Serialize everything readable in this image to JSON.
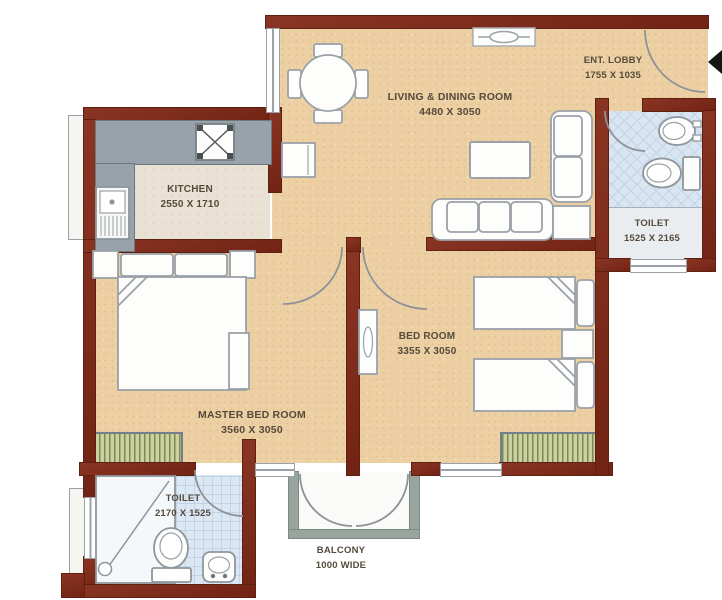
{
  "plan_title": "2BHK apartment floor plan",
  "rooms": {
    "living": {
      "name": "LIVING & DINING ROOM",
      "dims": "4480 X 3050"
    },
    "lobby": {
      "name": "ENT. LOBBY",
      "dims": "1755 X 1035"
    },
    "toilet_right": {
      "name": "TOILET",
      "dims": "1525 X 2165"
    },
    "kitchen": {
      "name": "KITCHEN",
      "dims": "2550 X 1710"
    },
    "master": {
      "name": "MASTER BED ROOM",
      "dims": "3560 X 3050"
    },
    "bedroom": {
      "name": "BED ROOM",
      "dims": "3355 X 3050"
    },
    "toilet_left": {
      "name": "TOILET",
      "dims": "2170 X 1525"
    },
    "balcony": {
      "name": "BALCONY",
      "dims": "1000 WIDE"
    }
  },
  "palette": {
    "wall": "#7b2c1c",
    "floor_rooms": "#ecd0a3",
    "floor_kitchen": "#e9e1d3",
    "floor_toilet": "#d9e5f1",
    "counter": "#98a2aa",
    "window_sill_hatch": "#ccd1a2",
    "balcony_wall": "#98a49e",
    "label_text": "#564a3c"
  },
  "furniture": {
    "living_dining": [
      "dining-table",
      "dining-chair",
      "wall-vent",
      "cabinet",
      "coffee-table",
      "sofa-3-seat",
      "sofa-2-seat",
      "corner-table"
    ],
    "kitchen": [
      "stove",
      "sink"
    ],
    "master_bedroom": [
      "double-bed",
      "nightstand",
      "dresser",
      "window-sill"
    ],
    "bedroom": [
      "single-bed",
      "single-bed",
      "nightstand",
      "wardrobe",
      "window-sill"
    ],
    "toilet_right": [
      "washbasin",
      "wc-toilet"
    ],
    "toilet_left": [
      "shower-area",
      "wc-toilet",
      "washbasin"
    ],
    "entrance": [
      "entry-arrow",
      "door-swing"
    ]
  }
}
